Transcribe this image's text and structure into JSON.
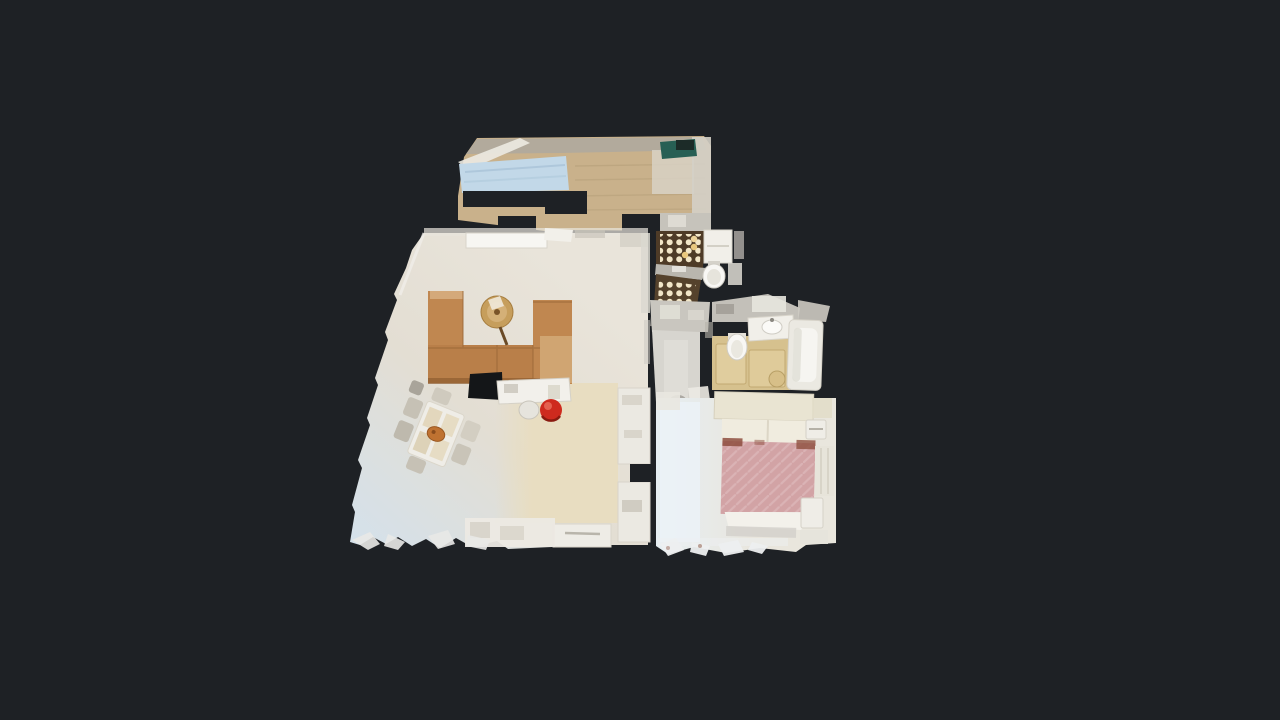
{
  "viewer": {
    "type": "3d-dollhouse-top-down-view",
    "background": "#1e2125"
  },
  "walls": {
    "light": "#f1efe9",
    "gray": "#c3c0b9"
  },
  "rooms": {
    "corridor": {
      "floor_wood": "#c9b18b",
      "skylight": "#c2d8e8",
      "top_wall": "#b2aa9c",
      "end_band": "#c6c3bb"
    },
    "living_room": {
      "floor_warm": "#e9e4da",
      "floor_mid": "#e3ded3",
      "floor_cool": "#d5e1ea",
      "shelf": "#f7f6f2"
    },
    "kitchen": {
      "floor": "#e8ddc1",
      "counter": "#ebe9e2",
      "lower_counter": "#eeece6"
    },
    "shower_room": {
      "floor": "#4e3b27",
      "floor_lower": "#55422c",
      "dots": "#f2e6c8",
      "dots_warm": "#e9c87e",
      "divider": "#b9b6ae"
    },
    "entry_hall": {
      "floor": "#d7d5cf",
      "upper": "#c9c6bf"
    },
    "bathroom": {
      "floor": "#d6c18e",
      "mat": "#e0cd9e",
      "wall": "#c3c0b9"
    },
    "bedroom": {
      "floor_cool": "#e6eef3",
      "floor_warm": "#e9e6dd",
      "wardrobe": "#e7e4da"
    }
  },
  "furniture": {
    "sofa": {
      "base": "#c08750",
      "seat": "#b97f49",
      "cushion_light": "#d0a572",
      "shadow": "#8f5c30"
    },
    "coffee_table": {
      "top": "#c69e5c",
      "inner": "#d4b077"
    },
    "dining_table": {
      "top": "#efede7",
      "placemat": "#e3d7bd",
      "chair": "#cfcabe",
      "plate": "#bf7231"
    },
    "kitchen_island": {
      "top": "#f2f0eb"
    },
    "red_stool": {
      "top": "#ce2a1e",
      "highlight": "#e86a58"
    },
    "white_stool": {
      "top": "#e6e4dd"
    },
    "bed": {
      "duvet": "#d2a3a5",
      "stripe": "#debabc",
      "headboard": "#e9e4d2",
      "pillows": "#f0ecdf",
      "sheet": "#f3f1eb",
      "trim": "#8e4f3f"
    },
    "bathtub": {
      "shell": "#ebe9e2",
      "basin": "#f6f5f1"
    },
    "toilet": {
      "body": "#f8f7f4",
      "seat": "#e6e4dc"
    },
    "sink": {
      "counter": "#f1efe9",
      "bowl": "#fbfaf7"
    },
    "bath_stool": {
      "top": "#d7bf88"
    },
    "teal_mat": {
      "top": "#275f54",
      "dark": "#1c2b28"
    }
  }
}
